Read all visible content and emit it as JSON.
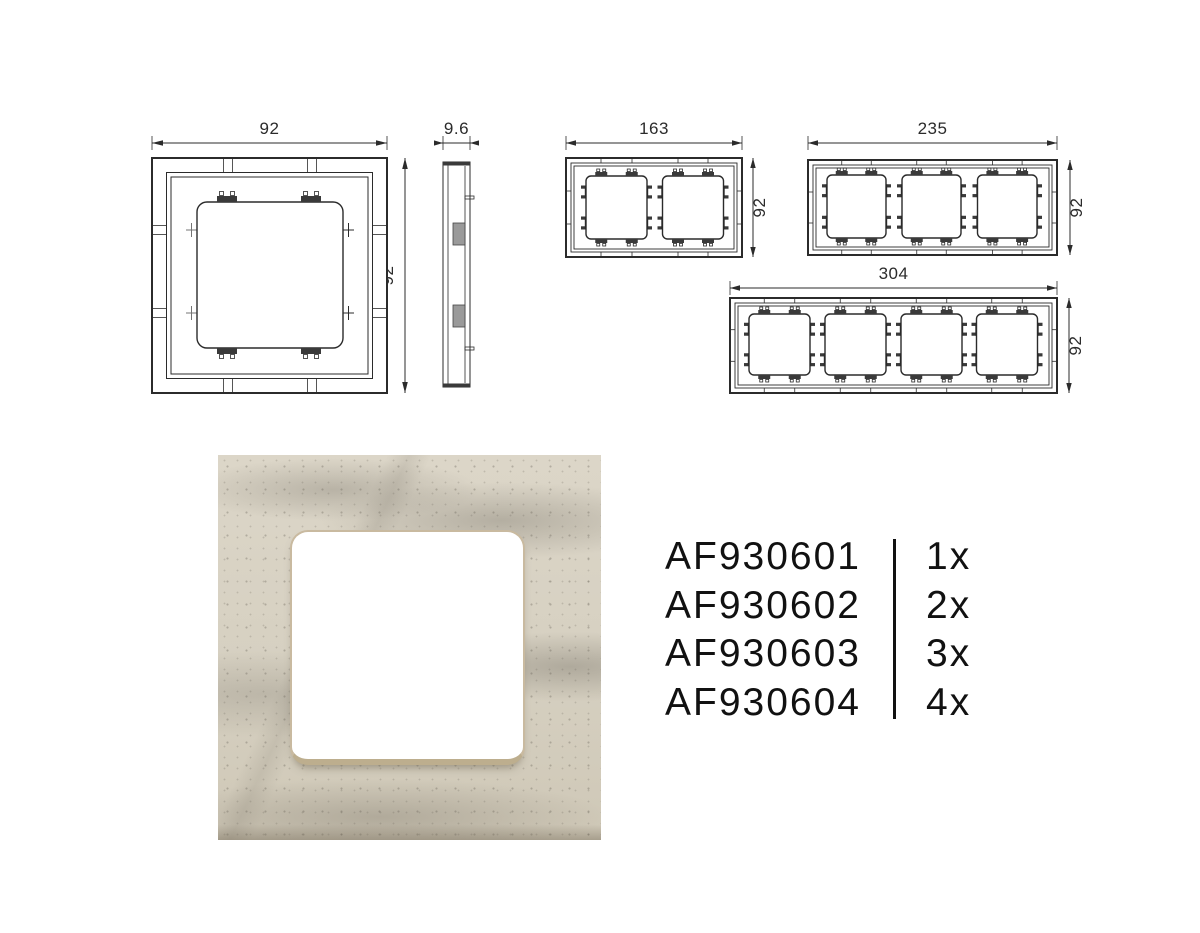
{
  "colors": {
    "line": "#2b2b2b",
    "marble_base": "#d8d2c4",
    "marble_shadow": "#cfc8b7",
    "opening_trim": "#c9baa0",
    "text": "#111111"
  },
  "drawings": {
    "single": {
      "width_mm": "92",
      "height_mm": "92"
    },
    "profile": {
      "depth_mm": "9.6"
    },
    "double": {
      "width_mm": "163",
      "height_mm": "92"
    },
    "triple": {
      "width_mm": "235",
      "height_mm": "92"
    },
    "quad": {
      "width_mm": "304",
      "height_mm": "92"
    }
  },
  "products": {
    "rows": [
      {
        "code": "AF930601",
        "qty": "1x"
      },
      {
        "code": "AF930602",
        "qty": "2x"
      },
      {
        "code": "AF930603",
        "qty": "3x"
      },
      {
        "code": "AF930604",
        "qty": "4x"
      }
    ]
  }
}
